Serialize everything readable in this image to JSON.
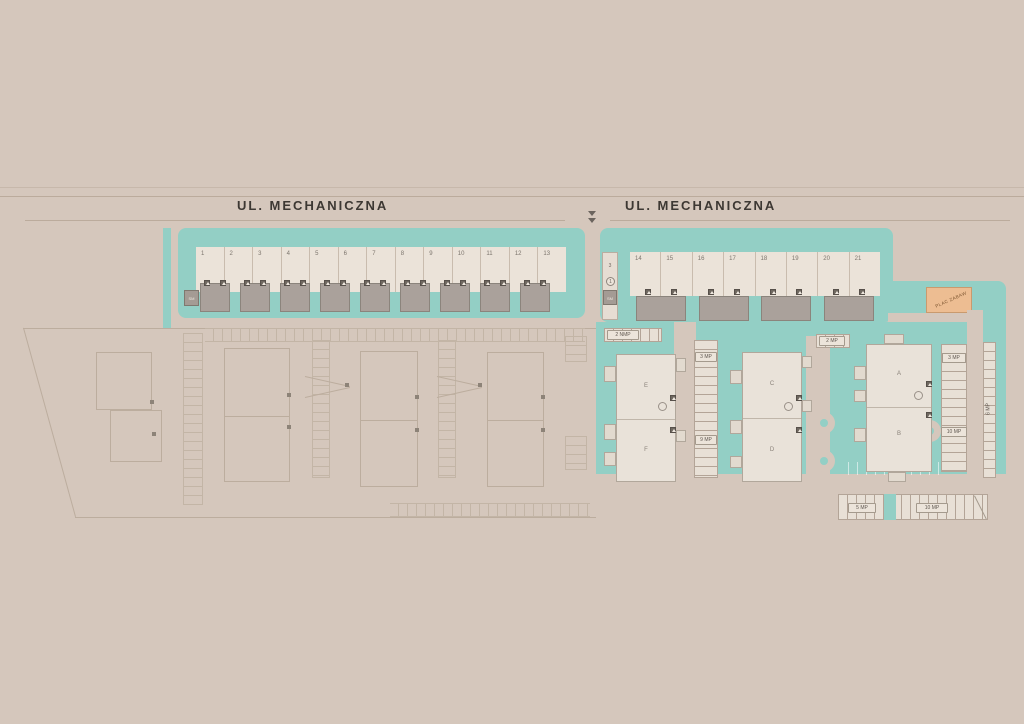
{
  "colors": {
    "background": "#d5c7bc",
    "teal": "#93cfc5",
    "plot_band": "#ebe3d9",
    "garage": "#aaa19b",
    "building": "#e9e2d9",
    "playground": "#edbd92",
    "outline_stroke": "#bcad9e",
    "street_text": "#3d3833"
  },
  "streets": {
    "left_label": "UL. MECHANICZNA",
    "right_label": "UL. MECHANICZNA"
  },
  "left_block": {
    "plots": [
      "1",
      "2",
      "3",
      "4",
      "5",
      "6",
      "7",
      "8",
      "9",
      "10",
      "11",
      "12",
      "13"
    ],
    "utility_box": "SM"
  },
  "right_block": {
    "plots": [
      "14",
      "15",
      "16",
      "17",
      "18",
      "19",
      "20",
      "21"
    ],
    "lane_number": "3",
    "lane_circle": "1",
    "utility_box": "SM"
  },
  "playground": {
    "label": "PLAC ZABAW"
  },
  "buildings": {
    "a": "A",
    "b": "B",
    "c": "C",
    "d": "D",
    "e": "E",
    "f": "F"
  },
  "parking": {
    "nmp_top": "2 NMP",
    "mp_2": "2 MP",
    "mp_3_mid": "3 MP",
    "mp_9": "9 MP",
    "mp_3_right": "3 MP",
    "mp_10_right": "10 MP",
    "mp_6_vertical": "6 MP",
    "mp_5_bottom": "5 MP",
    "mp_10_bottom": "10 MP"
  }
}
